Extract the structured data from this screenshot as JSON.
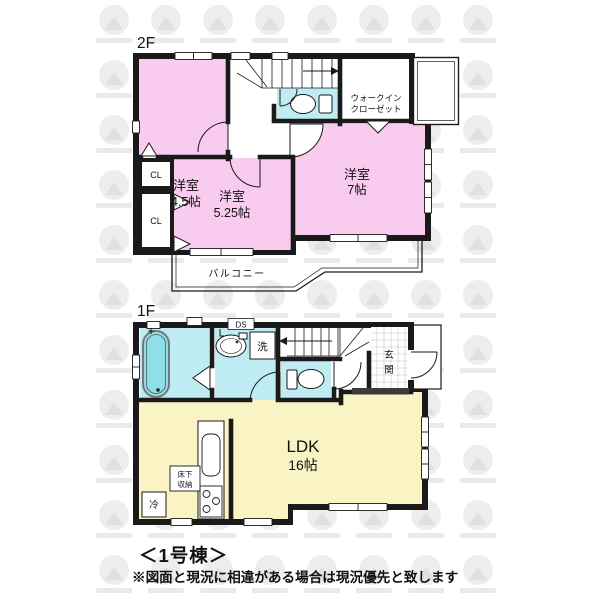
{
  "colors": {
    "room_pink": "#F8CBEF",
    "wet_cyan": "#BFECF2",
    "tub_cyan": "#8FDFE8",
    "ldk_yellow": "#FAF3C3",
    "wall_black": "#1a1a1a",
    "watermark_gray": "#ededed"
  },
  "floor2": {
    "label": "2F",
    "room_45": {
      "name": "洋室",
      "size": "4.5帖"
    },
    "room_525": {
      "name": "洋室",
      "size": "5.25帖"
    },
    "room_7": {
      "name": "洋室",
      "size": "7帖"
    },
    "wic": {
      "line1": "ウォークイン",
      "line2": "クローゼット"
    },
    "cl1": "CL",
    "cl2": "CL",
    "balcony": "バルコニー"
  },
  "floor1": {
    "label": "1F",
    "ldk": {
      "name": "LDK",
      "size": "16帖"
    },
    "genkan": {
      "char1": "玄",
      "char2": "関"
    },
    "laundry": "洗",
    "duct": "DS",
    "underfloor": {
      "line1": "床下",
      "line2": "収納"
    },
    "fridge": "冷"
  },
  "footer": {
    "building": "＜1号棟＞",
    "disclaimer": "※図面と現況に相違がある場合は現況優先と致します"
  }
}
